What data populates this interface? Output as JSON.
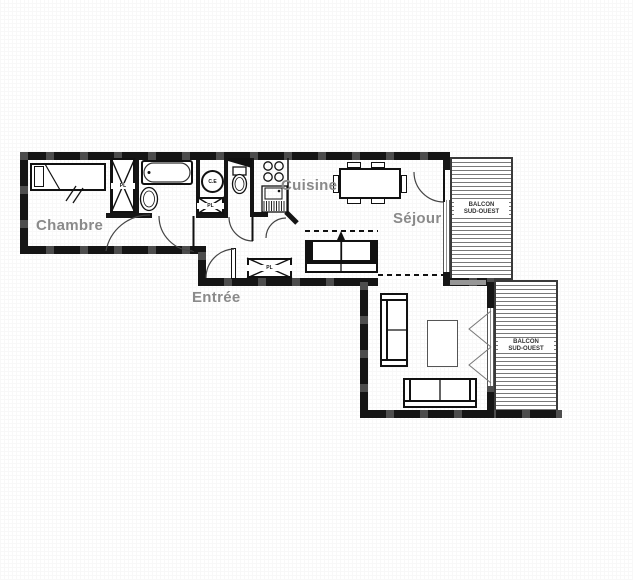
{
  "plan": {
    "rooms": [
      {
        "id": "chambre",
        "label": "Chambre"
      },
      {
        "id": "cuisine",
        "label": "Cuisine"
      },
      {
        "id": "sejour",
        "label": "Séjour"
      },
      {
        "id": "entree",
        "label": "Entrée"
      }
    ],
    "balconies": [
      {
        "id": "balcony-upper",
        "label_line1": "BALCON",
        "label_line2": "SUD-OUEST"
      },
      {
        "id": "balcony-lower",
        "label_line1": "BALCON",
        "label_line2": "SUD-OUEST"
      }
    ],
    "fixtures": {
      "water_heater": "C.E",
      "closet_bedroom": "PL",
      "closet_heater": "PL",
      "closet_entry": "PL"
    },
    "colors": {
      "wall": "#151515",
      "wall_accent": "#4d4d4d",
      "room_label": "#8a8a8a",
      "balcony_text": "#333333",
      "window_line": "#8f8f8f",
      "background": "#ffffff"
    }
  }
}
